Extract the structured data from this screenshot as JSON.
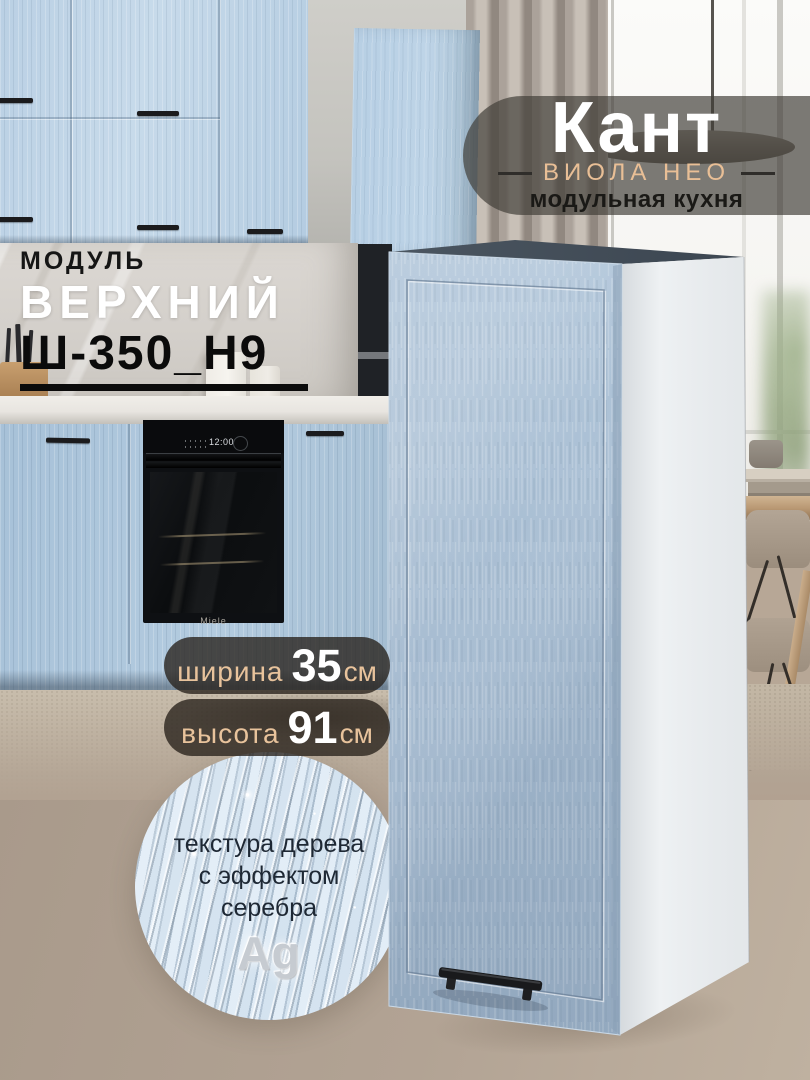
{
  "badge": {
    "title": "Кант",
    "series": "ВИОЛА НЕО",
    "tagline": "модульная кухня"
  },
  "module": {
    "label": "МОДУЛЬ",
    "name": "ВЕРХНИЙ",
    "code": "Ш-350_Н9"
  },
  "specs": [
    {
      "label": "ширина",
      "value": "35",
      "unit": "см"
    },
    {
      "label": "высота",
      "value": "91",
      "unit": "см"
    }
  ],
  "feature": {
    "line1": "текстура дерева",
    "line2": "с эффектом",
    "line3": "серебра",
    "symbol": "Ag"
  },
  "scene": {
    "oven_clock": "12:00",
    "oven_brand": "Miele"
  },
  "colors": {
    "accent_tan": "#e8c39c",
    "cabinet_front_blue": "#a9bfd4",
    "cabinet_side_white": "#eef1f3",
    "cabinet_top_dark": "#46505c",
    "badge_bg": "rgba(64,60,55,0.68)",
    "pill_bg": "rgba(38,32,25,0.78)",
    "wall_beige": "#b2a394",
    "text_dark": "#0b0b0b",
    "text_white": "#ffffff"
  }
}
